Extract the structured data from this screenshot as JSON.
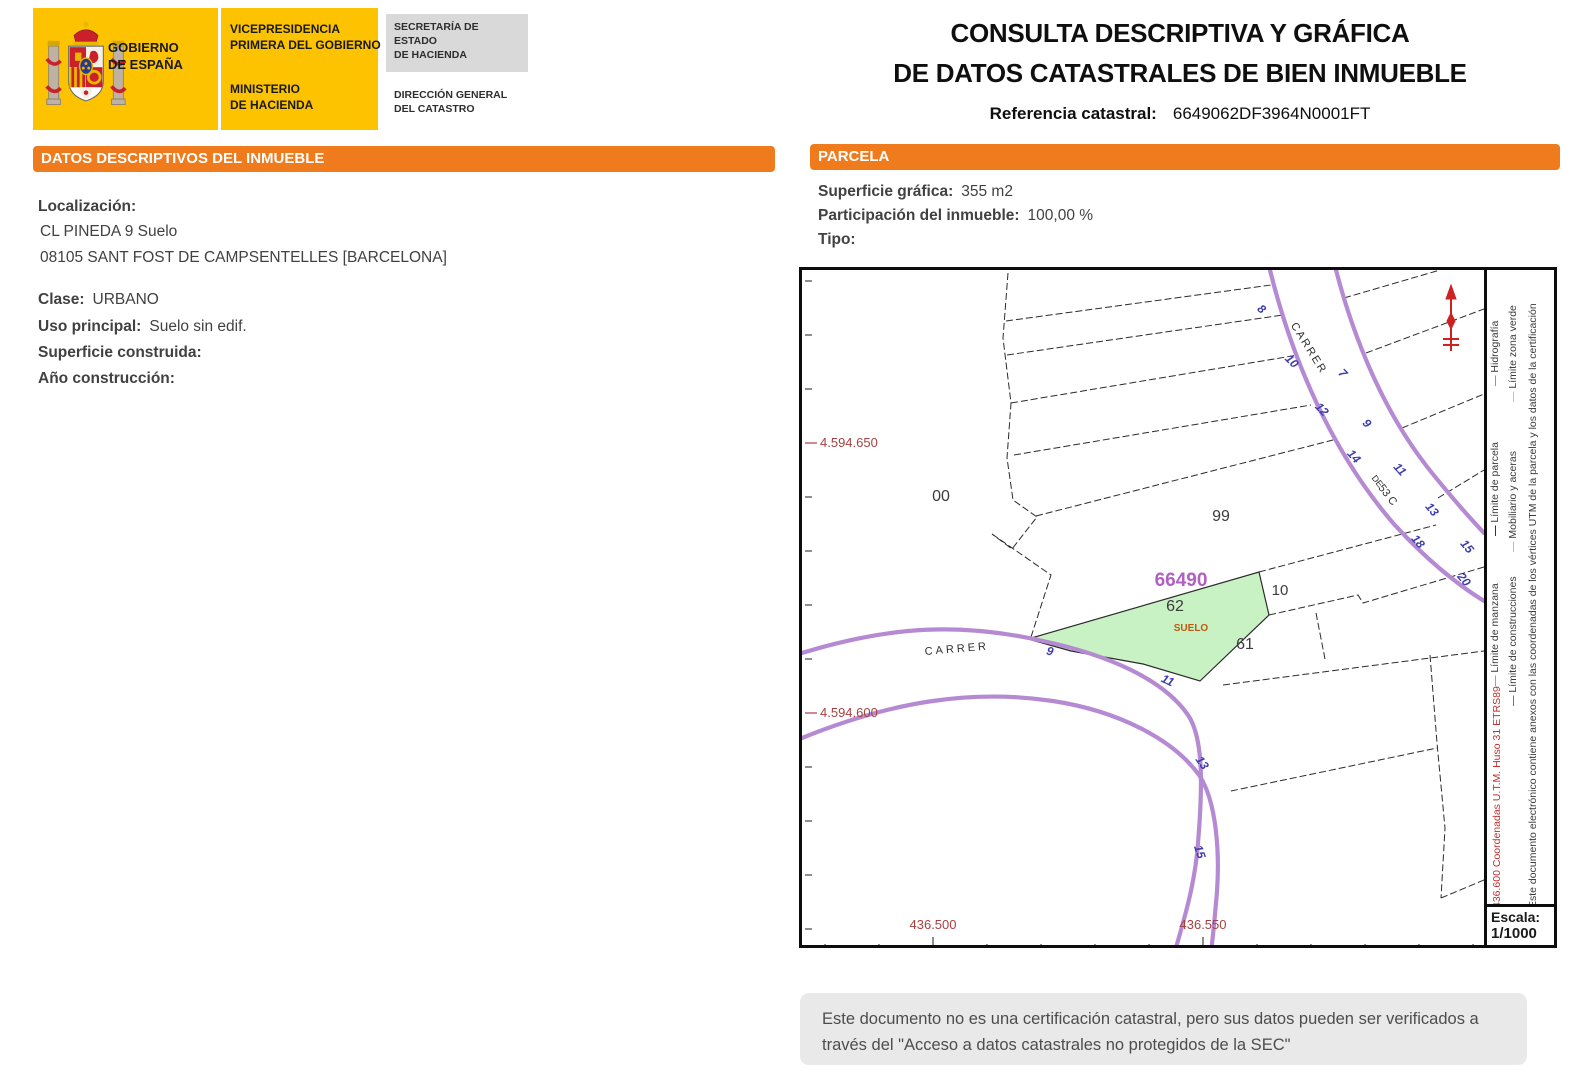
{
  "header": {
    "escudo_icon": "spanish-coat-of-arms",
    "gobierno_line1": "GOBIERNO",
    "gobierno_line2": "DE ESPAÑA",
    "vice_line1": "VICEPRESIDENCIA",
    "vice_line2": "PRIMERA DEL GOBIERNO",
    "min_line1": "MINISTERIO",
    "min_line2": "DE HACIENDA",
    "sec_line1": "SECRETARÍA DE ESTADO",
    "sec_line2": "DE HACIENDA",
    "dir_line1": "DIRECCIÓN GENERAL",
    "dir_line2": "DEL CATASTRO",
    "title_line1": "CONSULTA DESCRIPTIVA Y GRÁFICA",
    "title_line2": "DE DATOS CATASTRALES DE BIEN INMUEBLE",
    "ref_label": "Referencia catastral:",
    "ref_value": "6649062DF3964N0001FT"
  },
  "inmueble": {
    "section_title": "DATOS DESCRIPTIVOS DEL INMUEBLE",
    "localizacion_label": "Localización:",
    "address_line1": "CL PINEDA 9 Suelo",
    "address_line2": "08105 SANT FOST DE CAMPSENTELLES [BARCELONA]",
    "clase_label": "Clase:",
    "clase_value": "URBANO",
    "uso_label": "Uso principal:",
    "uso_value": "Suelo sin edif.",
    "superficie_label": "Superficie construida:",
    "superficie_value": "",
    "anio_label": "Año construcción:",
    "anio_value": ""
  },
  "parcela": {
    "section_title": "PARCELA",
    "superficie_label": "Superficie gráfica:",
    "superficie_value": "355 m2",
    "participacion_label": "Participación del inmueble:",
    "participacion_value": "100,00 %",
    "tipo_label": "Tipo:",
    "tipo_value": ""
  },
  "map": {
    "block_number": "66490",
    "parcel_number": "62",
    "suelo_tag": "SUELO",
    "label_00": "00",
    "label_99": "99",
    "label_10": "10",
    "label_61": "61",
    "street_a": "CARRER",
    "street_a_extra1": "DE",
    "street_a_extra2": "53 C",
    "street_b": "CARRER",
    "houses_a": [
      "8",
      "10",
      "12",
      "14",
      "18",
      "20",
      "7",
      "9",
      "11",
      "13",
      "15"
    ],
    "houses_b": [
      "9",
      "11",
      "13",
      "15"
    ],
    "y_label_1": "4.594.650",
    "y_label_2": "4.594.600",
    "x_label_1": "436.500",
    "x_label_2": "436.550",
    "north_icon": "north-arrow",
    "colors": {
      "road": "#b58ad2",
      "parcel_fill": "#c9f2c4",
      "block_number": "#b060c0",
      "coord_labels": "#a84040",
      "house_numbers": "#3d3db0",
      "suelo_tag": "#c05a10",
      "section_orange": "#ef7b1d",
      "logo_yellow": "#fdc300"
    }
  },
  "sidebar": {
    "legend": [
      {
        "label": "Límite de manzana",
        "color": "#b58ad2"
      },
      {
        "label": "Límite de parcela",
        "color": "#333333"
      },
      {
        "label": "Hidrografía",
        "color": "#8f8fd0"
      },
      {
        "label": "Límite de construcciones",
        "color": "#cc4a4a"
      },
      {
        "label": "Mobiliario y aceras",
        "color": "#bdbdbd"
      },
      {
        "label": "Límite zona verde",
        "color": "#a9d89e"
      }
    ],
    "coords_note": "436.600 Coordenadas U.T.M. Huso 31 ETRS89",
    "cert_note": "Este documento electrónico contiene anexos con las coordenadas de los vértices UTM de la parcela y los datos de la certificación",
    "escala_label": "Escala:",
    "escala_value": "1/1000"
  },
  "footer": {
    "disclaimer": "Este documento no es una certificación catastral, pero sus datos pueden ser verificados a través del \"Acceso a datos catastrales no protegidos de la SEC\""
  }
}
